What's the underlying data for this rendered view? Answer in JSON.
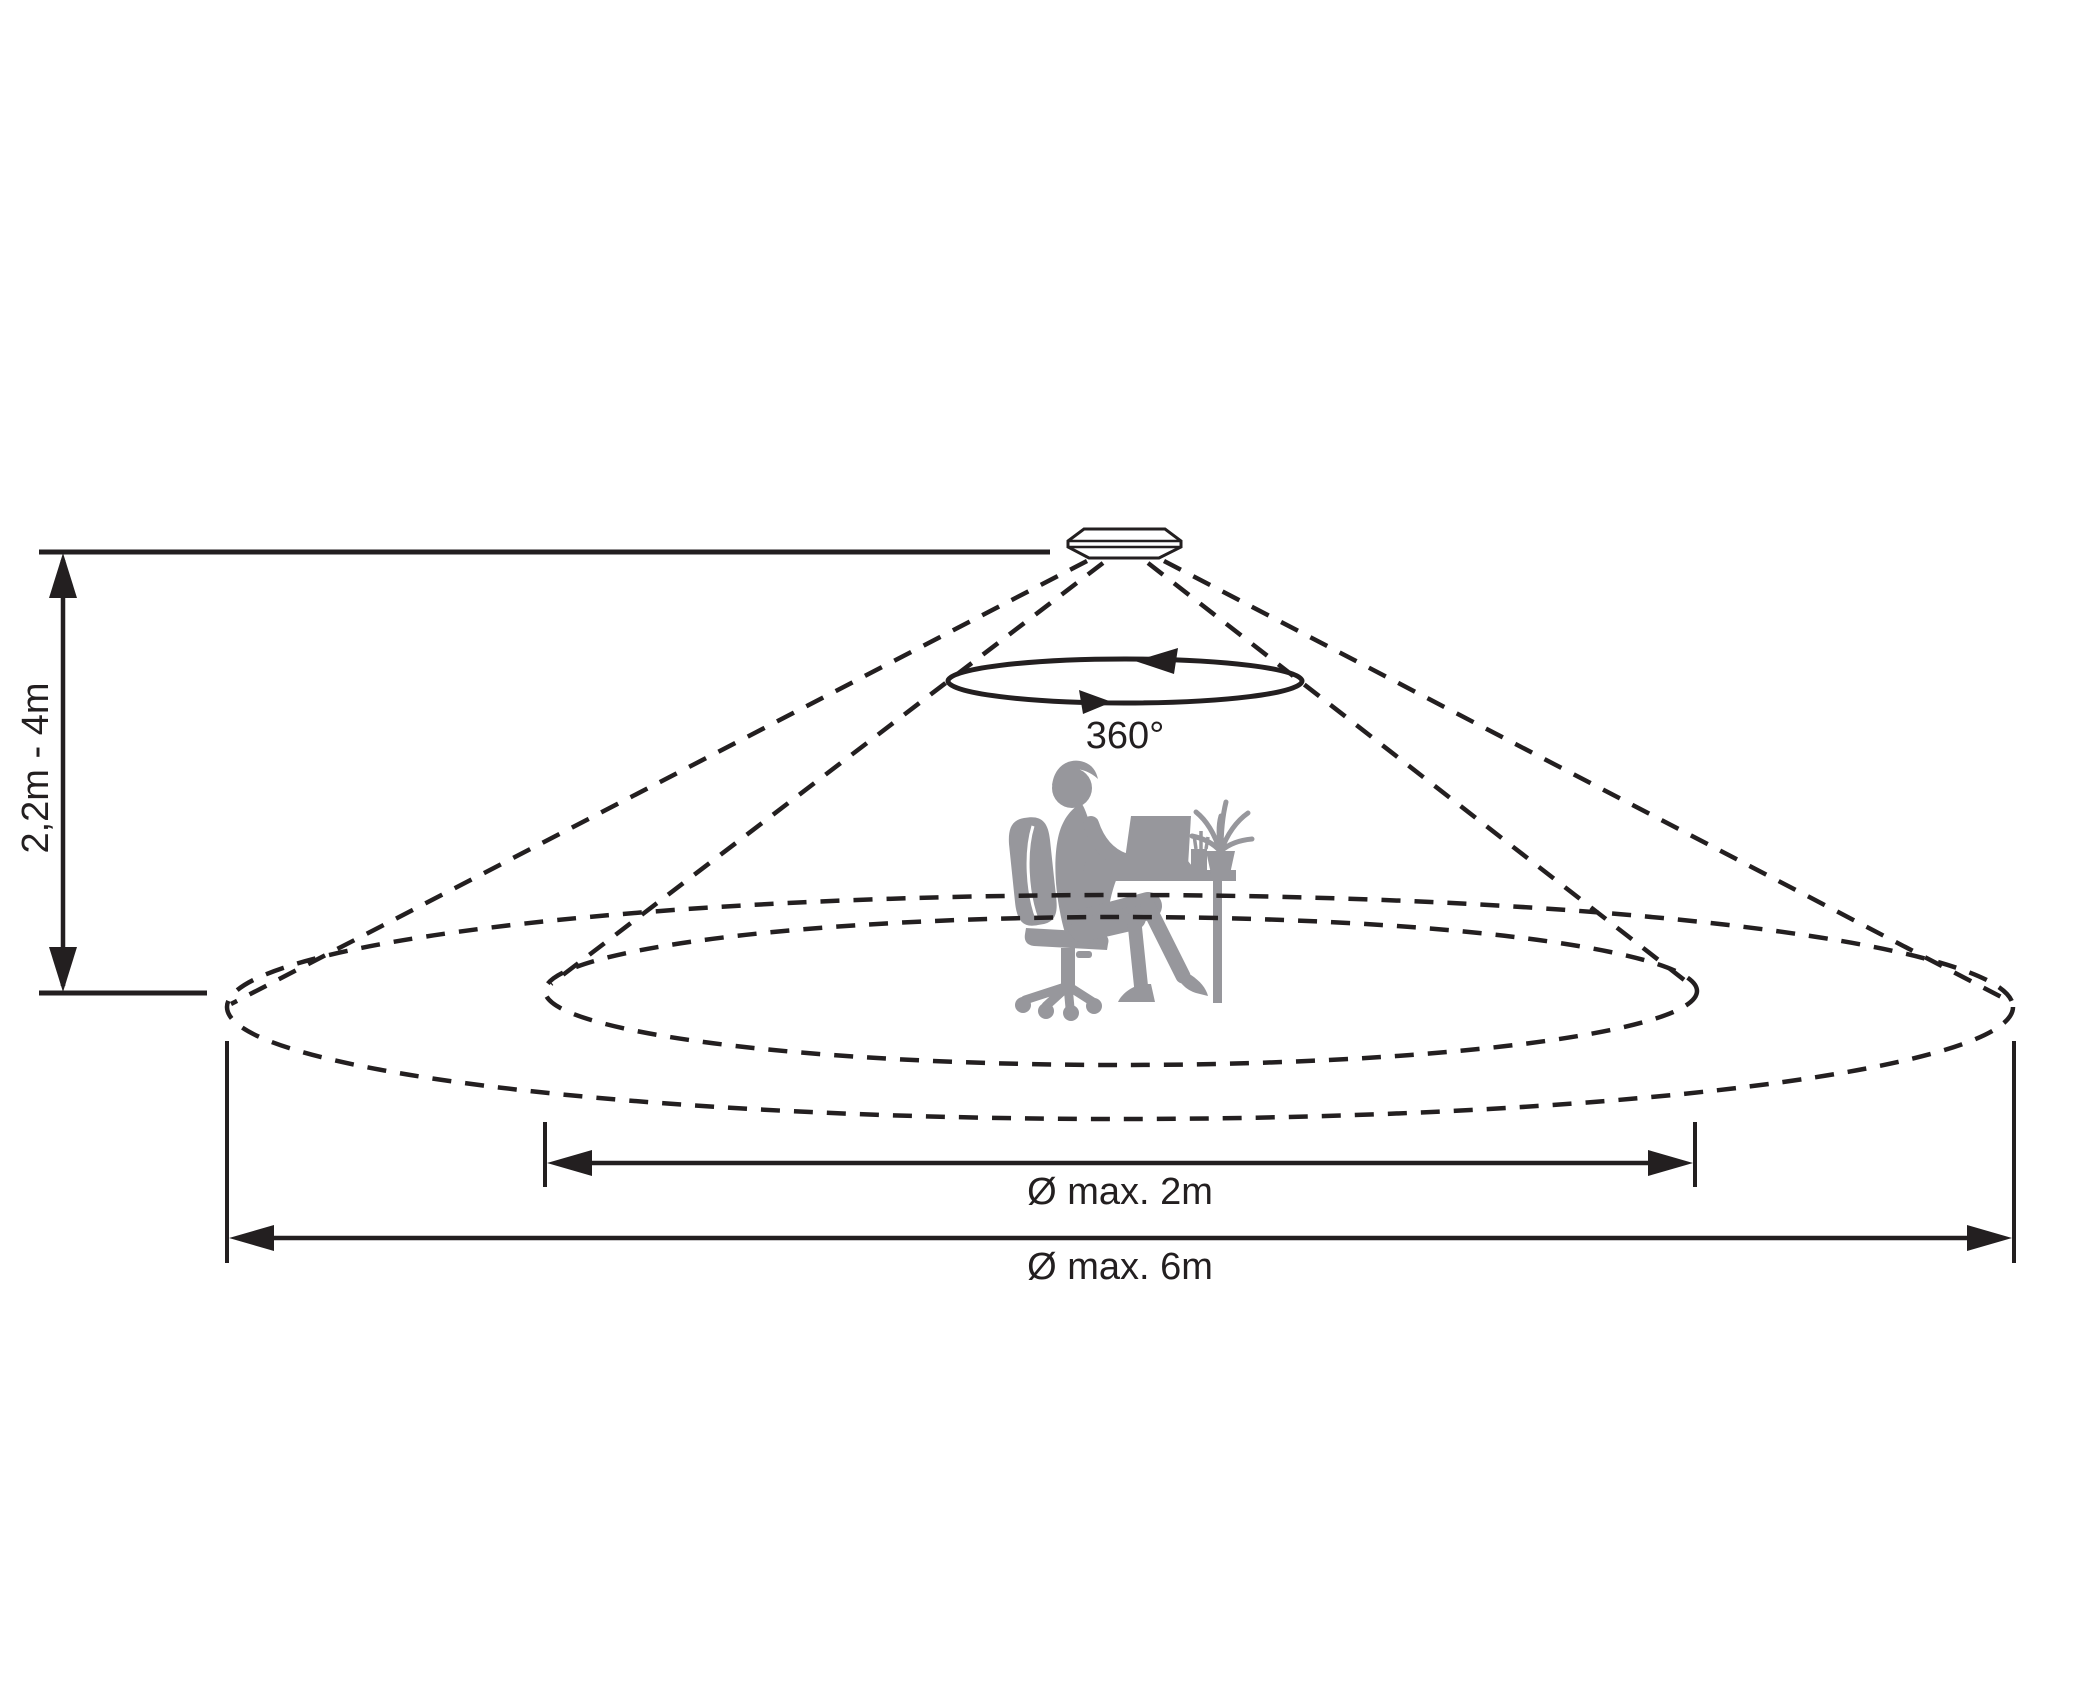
{
  "diagram": {
    "type": "ceiling-sensor-detection-range",
    "labels": {
      "mounting_height": "2,2m - 4m",
      "rotation_angle": "360°",
      "inner_diameter": "Ø max. 2m",
      "outer_diameter": "Ø max. 6m"
    },
    "figures": {
      "sensor": "ceiling-presence-sensor",
      "silhouette": "person-working-at-desk-with-laptop-and-plant",
      "zones": [
        "inner-presence-zone-dashed-ellipse",
        "outer-detection-zone-dashed-ellipse"
      ]
    },
    "colors": {
      "line": "#231f20",
      "silhouette": "#97979c",
      "background": "#ffffff"
    }
  }
}
